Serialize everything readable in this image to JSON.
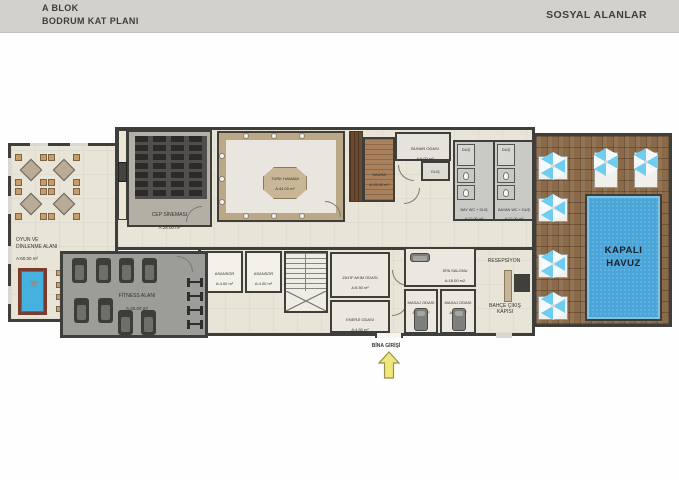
{
  "header": {
    "block_title": "A BLOK",
    "plan_title": "BODRUM KAT PLANI",
    "section_title": "SOSYAL ALANLAR"
  },
  "watermark": "RestProperty",
  "entrance": {
    "label": "BİNA GİRİŞİ"
  },
  "rooms": {
    "game": {
      "name": "OYUN VE\nDİNLENME ALANI",
      "area": "A:60.00 m²"
    },
    "cinema": {
      "name": "CEP SİNEMASI",
      "area": "A:28.00 m²"
    },
    "hamam": {
      "name": "TÜRK HAMAMI",
      "area": "A:44.00 m²"
    },
    "sauna": {
      "name": "SAUNA",
      "area": "A:15.50 m²"
    },
    "steam": {
      "name": "BUHAR ODASI",
      "area": "A:6.00 m²"
    },
    "shower": {
      "name": "DUŞ"
    },
    "men_wc": {
      "name": "BAY WC + DUŞ",
      "area": "A:12.00 m²"
    },
    "women_wc": {
      "name": "BAYAN WC + DUŞ",
      "area": "A:12.00 m²"
    },
    "pool": {
      "name": "KAPALI\nHAVUZ"
    },
    "fitness": {
      "name": "FİTNESS ALANI",
      "area": "A:40.00 m²"
    },
    "elevator": {
      "name": "ASANSÖR",
      "area": "A:4.00 m²"
    },
    "low_current": {
      "name": "ZAYIF AKIM ODASI",
      "area": "A:8.50 m²"
    },
    "energy": {
      "name": "ENERJİ ODASI",
      "area": "A:4.50 m²"
    },
    "spa": {
      "name": "SPA SALONU",
      "area": "A:18.00 m2"
    },
    "massage1": {
      "name": "MASAJ ODASI",
      "area": "A:9.50 m²"
    },
    "massage2": {
      "name": "MASAJ ODASI",
      "area": "A:5.00 m²"
    },
    "reception": {
      "name": "RESEPSİYON"
    },
    "garden_exit": {
      "name": "BAHÇE ÇIKIŞ\nKAPISI"
    }
  },
  "colors": {
    "wall": "#3e3e3b",
    "floor": "#e9e4d8",
    "pool_water": "#4aa5d8",
    "deck_wood": "#8a6a49",
    "fitness_floor": "#9c9c98",
    "header_bg": "#d2d1ce",
    "arrow_accent": "#f0e67c"
  }
}
